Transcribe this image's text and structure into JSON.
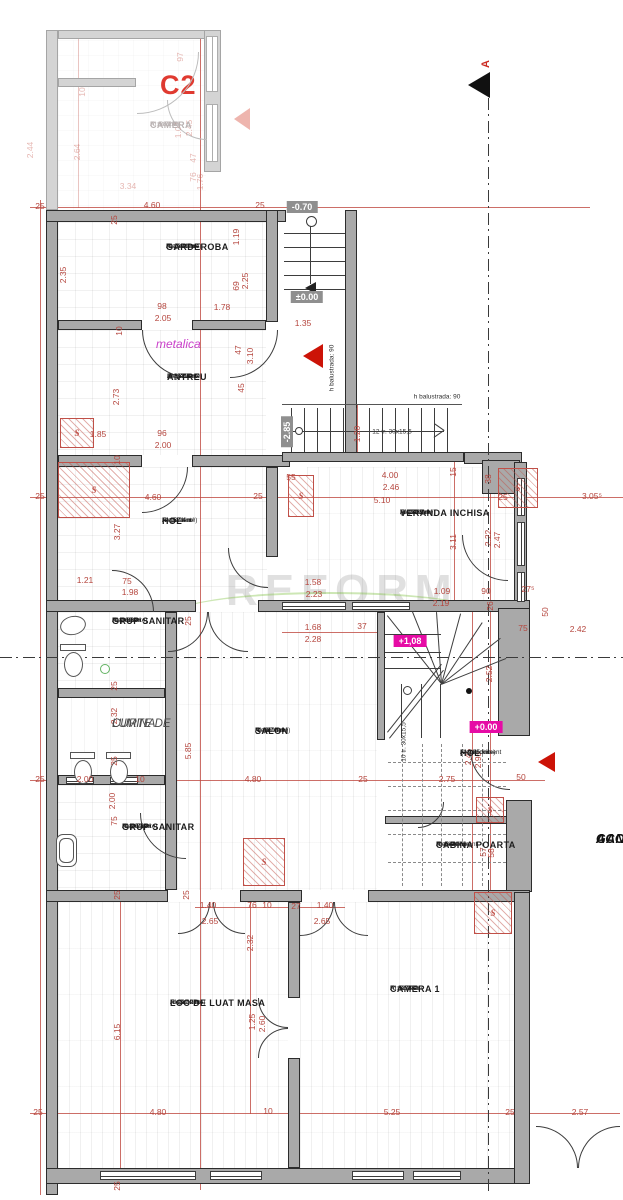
{
  "meta": {
    "drawing_type": "floor-plan",
    "unit_label": "C2"
  },
  "colors": {
    "dimension_red": "#b5463e",
    "marker_gray": "#8f8f8f",
    "marker_magenta": "#e60ba5",
    "wall_gray": "#a9a9a9",
    "accent_magenta": "#cb3fcb",
    "section_black": "#111111"
  },
  "annotations": {
    "metalica": "metalica",
    "watermark": "REFORM",
    "section_letter": "A",
    "shaft_letter": "S",
    "gang_line1": "GANG",
    "gang_line2": "ACCES"
  },
  "rooms": [
    {
      "n": [
        "CAMERA"
      ],
      "s": [
        "A: 8.83 m²",
        "HI: 2.72 m",
        "F: parchet"
      ],
      "x": 150,
      "y": 120,
      "c": "fad"
    },
    {
      "n": [
        "GARDEROBA"
      ],
      "s": [
        "(dependinte)",
        "A: 10.81 m²",
        "HI: 3.71 m",
        "F: gresie"
      ],
      "x": 166,
      "y": 242
    },
    {
      "n": [
        "ANTREU"
      ],
      "s": [
        "(dependinte)",
        "A: 12.56 m²",
        "HI: 3.71 m",
        "F: gresie"
      ],
      "x": 167,
      "y": 372
    },
    {
      "n": [
        "HOL"
      ],
      "s": [
        "(dependinte)",
        "A: 15.04 m²",
        "HI: 3.71 m",
        "F: gresie"
      ],
      "x": 162,
      "y": 516
    },
    {
      "n": [
        "VERANDA INCHISA"
      ],
      "s": [
        "(dependinte)",
        "A: 15.35 m²",
        "HI: 3.83 m",
        "F: parchet"
      ],
      "x": 400,
      "y": 508
    },
    {
      "n": [
        "GRUP SANITAR"
      ],
      "s": [
        "(dependinte)",
        "A: 2.86 m²",
        "HI: 3.83 m",
        "F: gresie"
      ],
      "x": 112,
      "y": 616
    },
    {
      "n": [
        "CURTE DE",
        "LUMINA"
      ],
      "s": [],
      "x": 112,
      "y": 718,
      "c": "it"
    },
    {
      "n": [
        "GRUP SANITAR"
      ],
      "s": [
        "(dependinte)",
        "A: 5.50 m²",
        "HI: 3.76 m",
        "F: gresie"
      ],
      "x": 122,
      "y": 822
    },
    {
      "n": [
        "SALON"
      ],
      "s": [
        "(dependinte)",
        "A: 28.08 m²",
        "HI: 3.74 m",
        "F: parchet"
      ],
      "x": 255,
      "y": 726
    },
    {
      "n": [
        "HOL"
      ],
      "s": [
        "(dependinte)",
        "A: 9.85 m²",
        "F: microciment"
      ],
      "x": 460,
      "y": 748
    },
    {
      "n": [
        "CABINA POARTA"
      ],
      "s": [
        "(dependinte)",
        "A: 1.48 m²",
        "HI: 3.74 m",
        "F: microciment"
      ],
      "x": 436,
      "y": 840
    },
    {
      "n": [
        "LOC DE LUAT MASA"
      ],
      "s": [
        "(dependinte)",
        "A: 29.12 m²",
        "HI: 3.74 m",
        "F: parchet"
      ],
      "x": 170,
      "y": 998
    },
    {
      "n": [
        "CAMERA 1"
      ],
      "s": [
        "A: 32.29 m²",
        "HI: 3.74 m",
        "F: parchet"
      ],
      "x": 390,
      "y": 984
    },
    {
      "n": [
        "GANG",
        "ACCES"
      ],
      "s": [],
      "x": 596,
      "y": 832,
      "c": "gang"
    }
  ],
  "levels": [
    {
      "t": "-0.70",
      "x": 302,
      "y": 207,
      "k": "g"
    },
    {
      "t": "±0.00",
      "x": 307,
      "y": 297,
      "k": "g"
    },
    {
      "t": "-2.85",
      "x": 287,
      "y": 432,
      "k": "g",
      "v": 1
    },
    {
      "t": "+1,08",
      "x": 410,
      "y": 641,
      "k": "m"
    },
    {
      "t": "+0.00",
      "x": 486,
      "y": 727,
      "k": "m"
    }
  ],
  "dims": [
    {
      "t": "10",
      "x": 82,
      "y": 92,
      "v": 1,
      "c": "f"
    },
    {
      "t": "97",
      "x": 180,
      "y": 57,
      "v": 1,
      "c": "f"
    },
    {
      "t": "2.44",
      "x": 30,
      "y": 150,
      "v": 1,
      "c": "f"
    },
    {
      "t": "2.64",
      "x": 77,
      "y": 152,
      "v": 1,
      "c": "f"
    },
    {
      "t": "1.07",
      "x": 178,
      "y": 130,
      "v": 1,
      "c": "f"
    },
    {
      "t": "2.45",
      "x": 189,
      "y": 128,
      "v": 1,
      "c": "f"
    },
    {
      "t": "47",
      "x": 193,
      "y": 158,
      "v": 1,
      "c": "f"
    },
    {
      "t": "76",
      "x": 193,
      "y": 177,
      "v": 1,
      "c": "f"
    },
    {
      "t": "1.76",
      "x": 200,
      "y": 182,
      "v": 1,
      "c": "f"
    },
    {
      "t": "3.34",
      "x": 128,
      "y": 186,
      "c": "f"
    },
    {
      "t": "25",
      "x": 40,
      "y": 206
    },
    {
      "t": "4.60",
      "x": 152,
      "y": 205
    },
    {
      "t": "25",
      "x": 260,
      "y": 205
    },
    {
      "t": "25",
      "x": 114,
      "y": 220,
      "v": 1
    },
    {
      "t": "2.35",
      "x": 63,
      "y": 275,
      "v": 1
    },
    {
      "t": "1.19",
      "x": 236,
      "y": 237,
      "v": 1
    },
    {
      "t": "69",
      "x": 236,
      "y": 286,
      "v": 1
    },
    {
      "t": "2.25",
      "x": 245,
      "y": 281,
      "v": 1
    },
    {
      "t": "98",
      "x": 162,
      "y": 306
    },
    {
      "t": "2.05",
      "x": 163,
      "y": 318
    },
    {
      "t": "1.78",
      "x": 222,
      "y": 307
    },
    {
      "t": "10",
      "x": 119,
      "y": 331,
      "v": 1
    },
    {
      "t": "47",
      "x": 238,
      "y": 350,
      "v": 1
    },
    {
      "t": "3.10",
      "x": 250,
      "y": 356,
      "v": 1
    },
    {
      "t": "2.73",
      "x": 116,
      "y": 397,
      "v": 1
    },
    {
      "t": "45",
      "x": 241,
      "y": 388,
      "v": 1
    },
    {
      "t": "1.85",
      "x": 98,
      "y": 434
    },
    {
      "t": "96",
      "x": 162,
      "y": 433
    },
    {
      "t": "2.00",
      "x": 163,
      "y": 445
    },
    {
      "t": "10",
      "x": 117,
      "y": 460,
      "v": 1
    },
    {
      "t": "4.60",
      "x": 153,
      "y": 497
    },
    {
      "t": "25",
      "x": 258,
      "y": 496
    },
    {
      "t": "25",
      "x": 40,
      "y": 496
    },
    {
      "t": "55",
      "x": 291,
      "y": 477
    },
    {
      "t": "3.27",
      "x": 117,
      "y": 532,
      "v": 1
    },
    {
      "t": "1.21",
      "x": 85,
      "y": 580
    },
    {
      "t": "75",
      "x": 127,
      "y": 581
    },
    {
      "t": "1.98",
      "x": 130,
      "y": 592
    },
    {
      "t": "1.35",
      "x": 303,
      "y": 323
    },
    {
      "t": "1.20",
      "x": 357,
      "y": 434,
      "v": 1
    },
    {
      "t": "4.00",
      "x": 390,
      "y": 475
    },
    {
      "t": "2.46",
      "x": 391,
      "y": 487
    },
    {
      "t": "5.10",
      "x": 382,
      "y": 500
    },
    {
      "t": "15",
      "x": 453,
      "y": 472,
      "v": 1
    },
    {
      "t": "38",
      "x": 488,
      "y": 479,
      "v": 1
    },
    {
      "t": "25",
      "x": 503,
      "y": 497
    },
    {
      "t": "3.05⁵",
      "x": 592,
      "y": 496
    },
    {
      "t": "3.11",
      "x": 453,
      "y": 542,
      "v": 1
    },
    {
      "t": "2.22",
      "x": 488,
      "y": 538,
      "v": 1
    },
    {
      "t": "2.47",
      "x": 497,
      "y": 540,
      "v": 1
    },
    {
      "t": "1.58",
      "x": 313,
      "y": 582
    },
    {
      "t": "2.23",
      "x": 314,
      "y": 594
    },
    {
      "t": "1.09",
      "x": 442,
      "y": 591
    },
    {
      "t": "2.19",
      "x": 441,
      "y": 603
    },
    {
      "t": "90",
      "x": 486,
      "y": 591
    },
    {
      "t": "27⁵",
      "x": 528,
      "y": 589
    },
    {
      "t": "25",
      "x": 188,
      "y": 621,
      "v": 1
    },
    {
      "t": "1.68",
      "x": 313,
      "y": 627
    },
    {
      "t": "2.28",
      "x": 313,
      "y": 639
    },
    {
      "t": "37",
      "x": 362,
      "y": 626
    },
    {
      "t": "26",
      "x": 490,
      "y": 606,
      "v": 1
    },
    {
      "t": "75",
      "x": 523,
      "y": 628
    },
    {
      "t": "50",
      "x": 545,
      "y": 612,
      "v": 1
    },
    {
      "t": "2.42",
      "x": 578,
      "y": 629
    },
    {
      "t": "2.52",
      "x": 489,
      "y": 674,
      "v": 1
    },
    {
      "t": "2.45",
      "x": 468,
      "y": 757,
      "v": 1
    },
    {
      "t": "2.95",
      "x": 478,
      "y": 760,
      "v": 1
    },
    {
      "t": "2.75",
      "x": 447,
      "y": 779
    },
    {
      "t": "50",
      "x": 521,
      "y": 777
    },
    {
      "t": "5.85",
      "x": 188,
      "y": 751,
      "v": 1
    },
    {
      "t": "4.80",
      "x": 253,
      "y": 779
    },
    {
      "t": "25",
      "x": 363,
      "y": 779
    },
    {
      "t": "25",
      "x": 40,
      "y": 779
    },
    {
      "t": "25",
      "x": 114,
      "y": 686,
      "v": 1
    },
    {
      "t": "2.32",
      "x": 114,
      "y": 716,
      "v": 1
    },
    {
      "t": "25",
      "x": 114,
      "y": 761,
      "v": 1
    },
    {
      "t": "2.00",
      "x": 85,
      "y": 779
    },
    {
      "t": "10",
      "x": 140,
      "y": 779
    },
    {
      "t": "2.00",
      "x": 112,
      "y": 801,
      "v": 1
    },
    {
      "t": "75",
      "x": 114,
      "y": 821,
      "v": 1
    },
    {
      "t": "57",
      "x": 483,
      "y": 852,
      "v": 1
    },
    {
      "t": "58",
      "x": 491,
      "y": 853,
      "v": 1
    },
    {
      "t": "25",
      "x": 117,
      "y": 895,
      "v": 1
    },
    {
      "t": "25",
      "x": 186,
      "y": 895,
      "v": 1
    },
    {
      "t": "1.40",
      "x": 208,
      "y": 905
    },
    {
      "t": "2.65",
      "x": 210,
      "y": 921
    },
    {
      "t": "76",
      "x": 252,
      "y": 905
    },
    {
      "t": "10",
      "x": 267,
      "y": 905
    },
    {
      "t": "27",
      "x": 296,
      "y": 906
    },
    {
      "t": "1.40",
      "x": 325,
      "y": 905
    },
    {
      "t": "2.65",
      "x": 322,
      "y": 921
    },
    {
      "t": "2.32",
      "x": 250,
      "y": 943,
      "v": 1
    },
    {
      "t": "1.25",
      "x": 252,
      "y": 1022,
      "v": 1
    },
    {
      "t": "2.60",
      "x": 262,
      "y": 1024,
      "v": 1
    },
    {
      "t": "6.15",
      "x": 117,
      "y": 1032,
      "v": 1
    },
    {
      "t": "25",
      "x": 38,
      "y": 1112
    },
    {
      "t": "4.80",
      "x": 158,
      "y": 1112
    },
    {
      "t": "10",
      "x": 268,
      "y": 1111
    },
    {
      "t": "5.25",
      "x": 392,
      "y": 1112
    },
    {
      "t": "25",
      "x": 510,
      "y": 1112
    },
    {
      "t": "2.57",
      "x": 580,
      "y": 1112
    },
    {
      "t": "25",
      "x": 117,
      "y": 1186,
      "v": 1
    },
    {
      "t": "h balustrada: 90",
      "x": 332,
      "y": 368,
      "v": 1,
      "c": "n"
    },
    {
      "t": "h balustrada: 90",
      "x": 437,
      "y": 397,
      "c": "n"
    },
    {
      "t": "12 tr. 30x15,5",
      "x": 392,
      "y": 432,
      "c": "n"
    },
    {
      "t": "10 tr. 30x15,5",
      "x": 404,
      "y": 742,
      "v": 1,
      "c": "n"
    }
  ],
  "shafts": [
    {
      "x": 60,
      "y": 418,
      "w": 34,
      "h": 30
    },
    {
      "x": 58,
      "y": 462,
      "w": 72,
      "h": 56
    },
    {
      "x": 288,
      "y": 475,
      "w": 26,
      "h": 42
    },
    {
      "x": 498,
      "y": 468,
      "w": 40,
      "h": 40
    },
    {
      "x": 243,
      "y": 838,
      "w": 42,
      "h": 48
    },
    {
      "x": 476,
      "y": 797,
      "w": 28,
      "h": 26
    },
    {
      "x": 474,
      "y": 892,
      "w": 38,
      "h": 42
    }
  ]
}
